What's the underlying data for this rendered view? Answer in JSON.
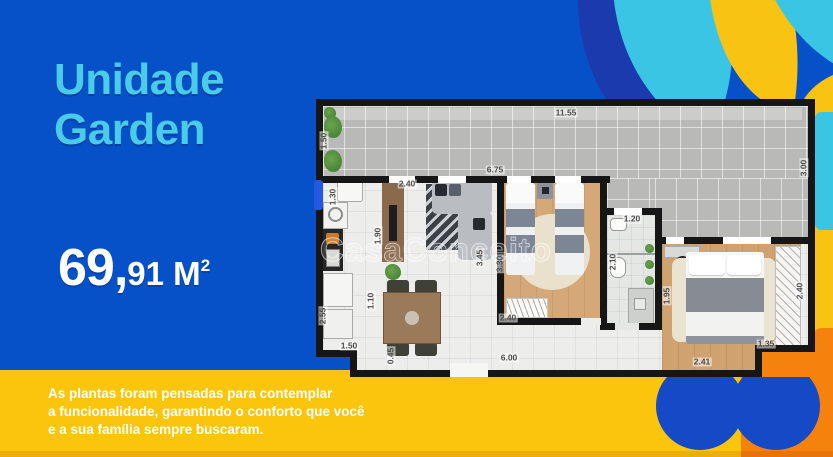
{
  "header": {
    "title_line1": "Unidade",
    "title_line2": "Garden"
  },
  "area": {
    "major": "69,",
    "minor": "91",
    "unit": " M",
    "sup": "2"
  },
  "description": {
    "line1": "As plantas foram pensadas para contemplar",
    "line2": "a funcionalidade, garantindo o conforto que você",
    "line3": "e a sua família sempre buscaram."
  },
  "floorplan": {
    "watermark": "CasaConceito",
    "dimensions": [
      {
        "text": "11.55",
        "x": 566,
        "y": 113,
        "rot": false
      },
      {
        "text": "1.50",
        "x": 324,
        "y": 141,
        "rot": true
      },
      {
        "text": "3.00",
        "x": 804,
        "y": 168,
        "rot": true
      },
      {
        "text": "6.75",
        "x": 495,
        "y": 170,
        "rot": false
      },
      {
        "text": "2.40",
        "x": 407,
        "y": 184,
        "rot": false
      },
      {
        "text": "1.30",
        "x": 333,
        "y": 197,
        "rot": true
      },
      {
        "text": "1.90",
        "x": 378,
        "y": 236,
        "rot": true
      },
      {
        "text": "3.45",
        "x": 480,
        "y": 258,
        "rot": true
      },
      {
        "text": "3.30",
        "x": 500,
        "y": 264,
        "rot": true
      },
      {
        "text": "2.40",
        "x": 508,
        "y": 318,
        "rot": false
      },
      {
        "text": "1.20",
        "x": 632,
        "y": 219,
        "rot": false
      },
      {
        "text": "2.10",
        "x": 613,
        "y": 262,
        "rot": true
      },
      {
        "text": "1.10",
        "x": 371,
        "y": 301,
        "rot": true
      },
      {
        "text": "2.55",
        "x": 323,
        "y": 316,
        "rot": true
      },
      {
        "text": "1.50",
        "x": 349,
        "y": 346,
        "rot": false
      },
      {
        "text": "0.45",
        "x": 391,
        "y": 356,
        "rot": true
      },
      {
        "text": "6.00",
        "x": 509,
        "y": 358,
        "rot": false
      },
      {
        "text": "1.95",
        "x": 667,
        "y": 296,
        "rot": true
      },
      {
        "text": "2.40",
        "x": 800,
        "y": 291,
        "rot": true
      },
      {
        "text": "2.41",
        "x": 702,
        "y": 362,
        "rot": false
      },
      {
        "text": "1.35",
        "x": 766,
        "y": 344,
        "rot": false
      }
    ]
  },
  "colors": {
    "blue": "#0751C8",
    "cyan_text": "#4ACBE8",
    "yellow": "#FCC50D",
    "orange": "#F5820D",
    "navy": "#1B3AAE",
    "cyan": "#3BC5E5",
    "royal": "#1549C5"
  }
}
